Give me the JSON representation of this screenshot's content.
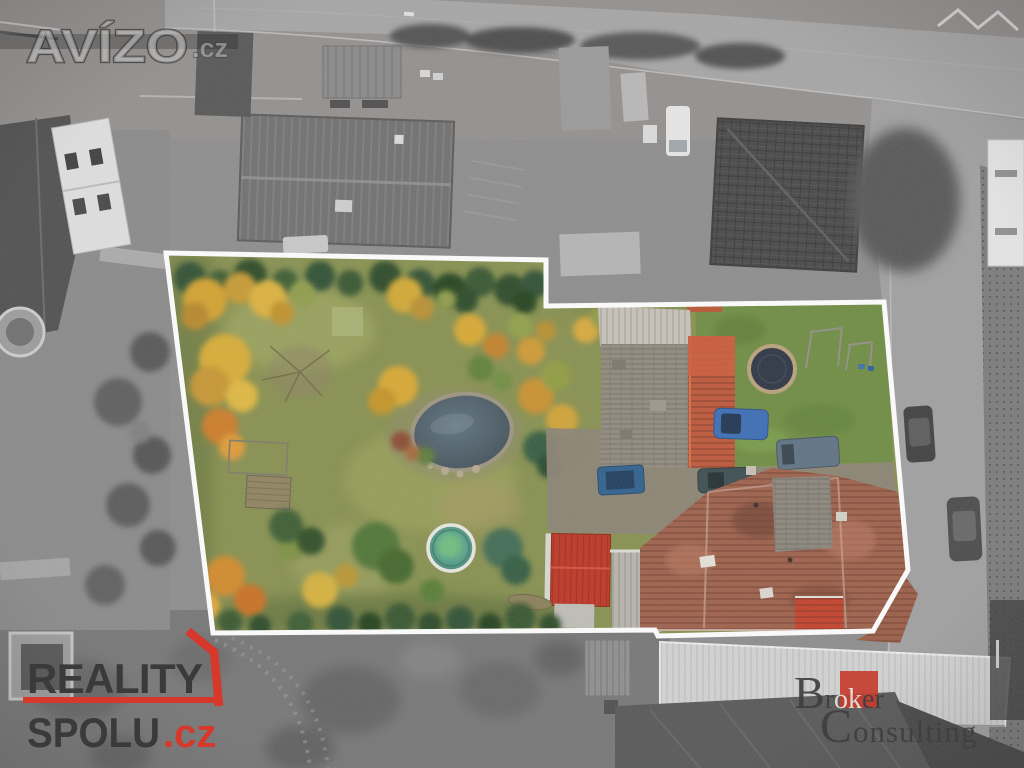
{
  "watermarks": {
    "avizo": {
      "brand": "AVÍZO",
      "tld": ".cz"
    },
    "reality_spolu": {
      "line1": "REALITY",
      "line2": "SPOLU",
      "tld": ".cz",
      "text_color": "#3a3a3a",
      "accent_color": "#d6392b"
    },
    "broker_consulting": {
      "word1_initial": "B",
      "word1_pre": "r",
      "word1_boxed": "ok",
      "word1_post": "er",
      "word2_initial": "C",
      "word2_rest": "onsulting",
      "text_color": "#3f3f3f",
      "boxed_text_color": "#e9e5dc",
      "accent_color": "#c63d2f"
    }
  },
  "property_highlight": {
    "outline_color": "#ffffff",
    "outline_width_px": 5
  },
  "scene_palette": {
    "background_gray": "#8d8d8d",
    "road_gray": "#a6a6a6",
    "lawn_olive": "#87904f",
    "lawn_bright": "#6e8c41",
    "autumn_yellow": "#d8ac36",
    "autumn_orange": "#cd7c27",
    "hedge_green": "#2f5030",
    "pond_water": "#50626c",
    "pool_water": "#4f9781",
    "house_roof_red": "#9d604a",
    "shed_red": "#bf3524",
    "barn_red": "#bd5638",
    "car_blue": "#3a6cb4"
  }
}
